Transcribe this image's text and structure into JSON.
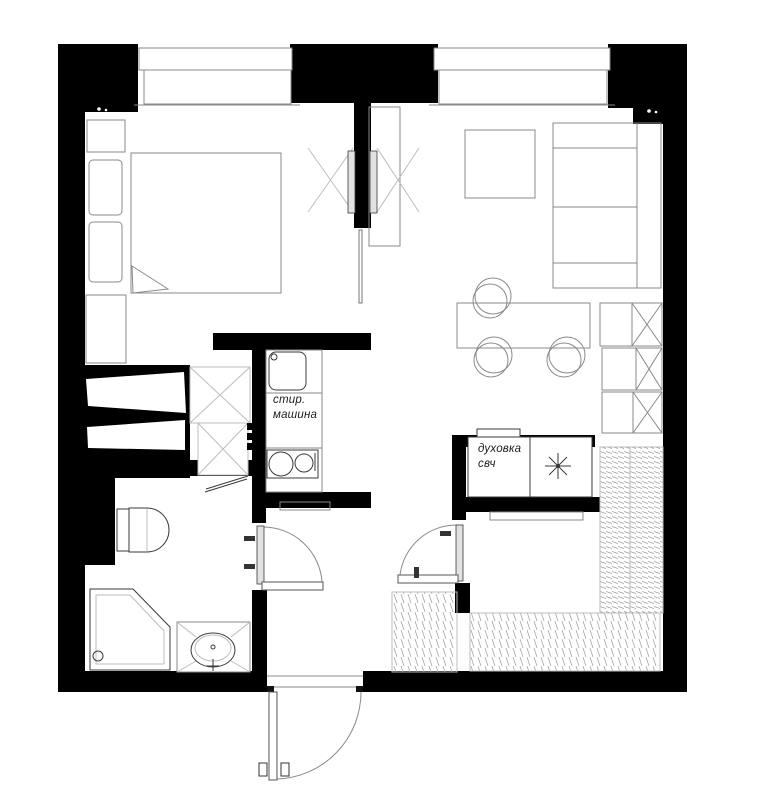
{
  "labels": {
    "washer_line1": "стир.",
    "washer_line2": "машина",
    "oven_line1": "духовка",
    "oven_line2": "свч"
  },
  "icons": {
    "star_light": "✳",
    "wardrobe_cross": "✕"
  },
  "colors": {
    "wall": "#000000",
    "bg": "#ffffff",
    "line_dark": "#3a3a3a",
    "line_mid": "#8a8a8a",
    "line_light": "#bdbdbd",
    "panel": "#e2e2e2",
    "text": "#1c1c1c"
  }
}
